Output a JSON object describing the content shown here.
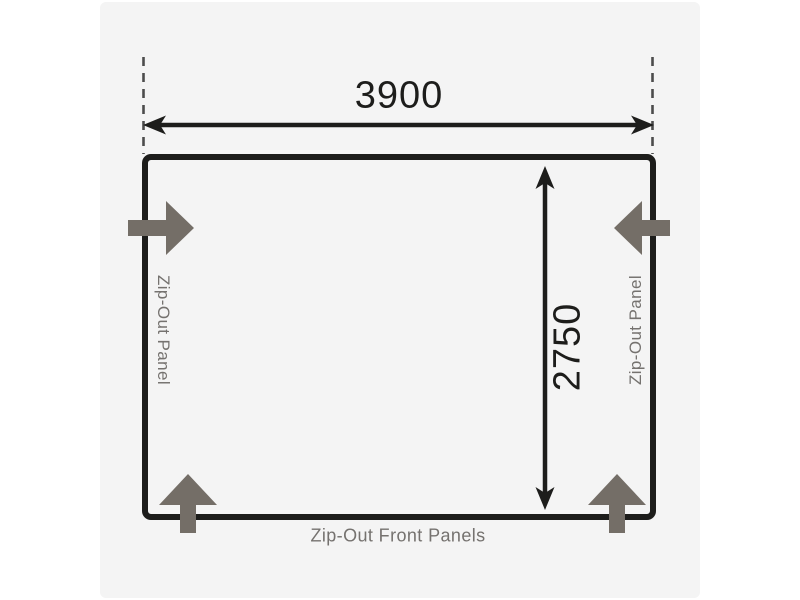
{
  "diagram": {
    "width_label": "3900",
    "depth_label": "2750",
    "left_panel_label": "Zip-Out Panel",
    "right_panel_label": "Zip-Out Panel",
    "front_panels_label": "Zip-Out Front Panels"
  },
  "icons": {
    "zip_out_arrow_left": "thick-arrow-pointing-right-through-left-wall",
    "zip_out_arrow_right": "thick-arrow-pointing-left-through-right-wall",
    "zip_out_arrow_bottom_left": "thick-arrow-pointing-up-through-front-wall",
    "zip_out_arrow_bottom_right": "thick-arrow-pointing-up-through-front-wall",
    "width_dimension_arrow": "double-headed-horizontal-measurement-arrow",
    "depth_dimension_arrow": "double-headed-vertical-measurement-arrow"
  },
  "colors": {
    "page_background": "#ffffff",
    "canvas_background": "#f4f4f4",
    "outline": "#1d1d1b",
    "dimension_line": "#1d1d1b",
    "extension_dash": "#4c4c4c",
    "zip_arrow": "#746e67",
    "muted_label": "#75726f"
  }
}
